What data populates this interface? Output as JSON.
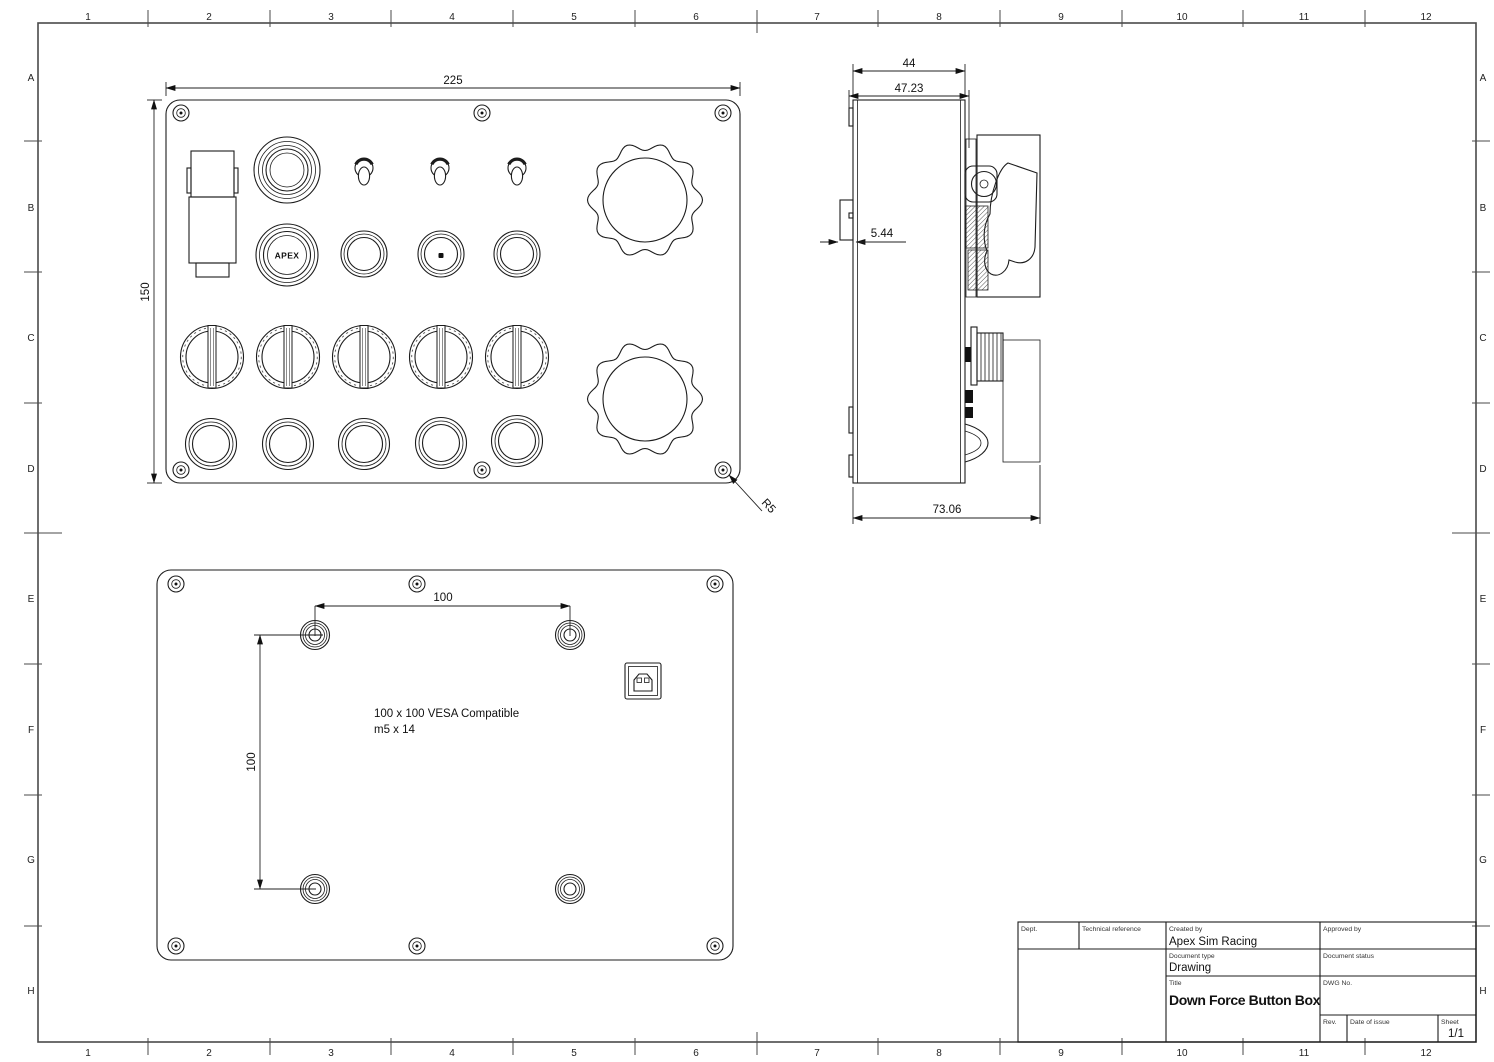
{
  "drawing": {
    "grid": {
      "columns": [
        "1",
        "2",
        "3",
        "4",
        "5",
        "6",
        "7",
        "8",
        "9",
        "10",
        "11",
        "12"
      ],
      "rows": [
        "A",
        "B",
        "C",
        "D",
        "E",
        "F",
        "G",
        "H"
      ]
    },
    "front": {
      "dims": {
        "width": "225",
        "height": "150",
        "radius": "R5"
      },
      "apex_label": "APEX"
    },
    "side": {
      "dims": {
        "body": "44",
        "outer": "47.23",
        "guard": "5.44",
        "total": "73.06"
      }
    },
    "back": {
      "dims": {
        "horizontal": "100",
        "vertical": "100"
      },
      "notes": [
        "100 x 100 VESA Compatible",
        "m5 x 14"
      ]
    },
    "title_block": {
      "labels": {
        "dept": "Dept.",
        "technical_reference": "Technical reference",
        "created_by": "Created by",
        "approved_by": "Approved by",
        "document_type": "Document type",
        "document_status": "Document status",
        "title": "Title",
        "dwg_no": "DWG No.",
        "rev": "Rev.",
        "date_of_issue": "Date of issue",
        "sheet": "Sheet"
      },
      "values": {
        "created_by": "Apex Sim Racing",
        "document_type": "Drawing",
        "title": "Down Force Button Box",
        "sheet": "1/1"
      }
    }
  }
}
